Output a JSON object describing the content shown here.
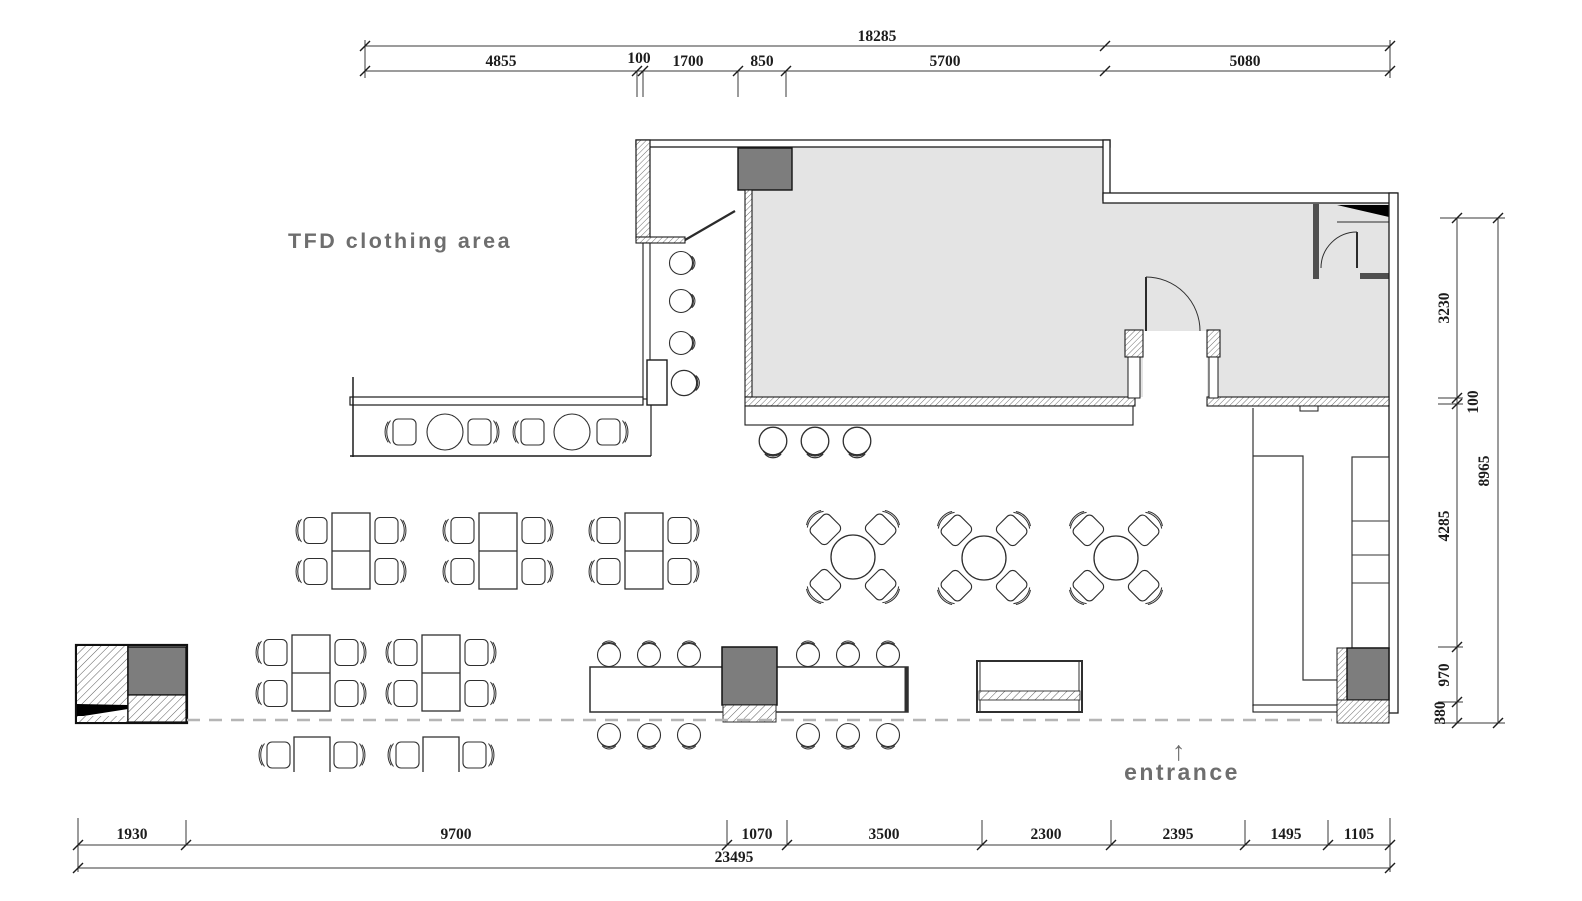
{
  "labels": {
    "clothing_area": "TFD clothing area",
    "entrance": "entrance",
    "entrance_arrow": "↑"
  },
  "dimensions": {
    "top": {
      "total": "18285",
      "segments": [
        "4855",
        "100",
        "1700",
        "850",
        "5700",
        "5080"
      ]
    },
    "right": {
      "total": "8965",
      "segments": [
        "3230",
        "100",
        "4285",
        "970",
        "380"
      ]
    },
    "bottom": {
      "total": "23495",
      "segments": [
        "1930",
        "9700",
        "1070",
        "3500",
        "2300",
        "2395",
        "1495",
        "1105"
      ]
    }
  },
  "colors": {
    "room_fill": "#e4e4e4",
    "dark_fill": "#7d7d7d",
    "wall_dark": "#4f4f4f",
    "black": "#000000",
    "annotation_text": "#6e6e6e",
    "dashed_line": "#b5b5b5",
    "line": "#2b2b2b"
  }
}
